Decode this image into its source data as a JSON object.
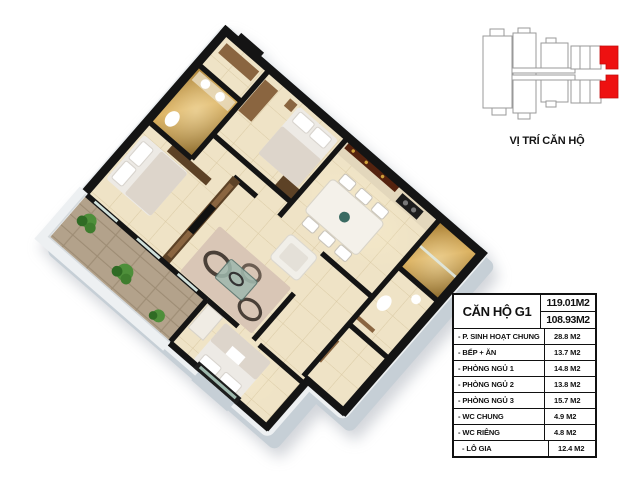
{
  "colors": {
    "accent_red": "#ee1111",
    "wall_black": "#141414",
    "floor_cream": "#efe3c6",
    "balcony_floor": "#b3a28b",
    "gold_wall": "#c2953f",
    "wood": "#8a6540",
    "outer_wall": "#c6cfd6",
    "table_border": "#111111"
  },
  "location_map": {
    "label": "VỊ TRÍ CĂN HỘ"
  },
  "area_table": {
    "unit_name": "CĂN HỘ G1",
    "gross_area": "119.01M2",
    "net_area": "108.93M2",
    "rows": [
      {
        "label": "- P. SINH HOẠT CHUNG",
        "value": "28.8 M2"
      },
      {
        "label": "- BẾP + ĂN",
        "value": "13.7 M2"
      },
      {
        "label": "- PHÒNG NGỦ 1",
        "value": "14.8 M2"
      },
      {
        "label": "- PHÒNG NGỦ 2",
        "value": "13.8 M2"
      },
      {
        "label": "- PHÒNG NGỦ 3",
        "value": "15.7 M2"
      },
      {
        "label": "- WC CHUNG",
        "value": "4.9 M2"
      },
      {
        "label": "- WC RIÊNG",
        "value": "4.8 M2"
      },
      {
        "label": "- LÔ GIA",
        "value": "12.4 M2"
      }
    ]
  }
}
